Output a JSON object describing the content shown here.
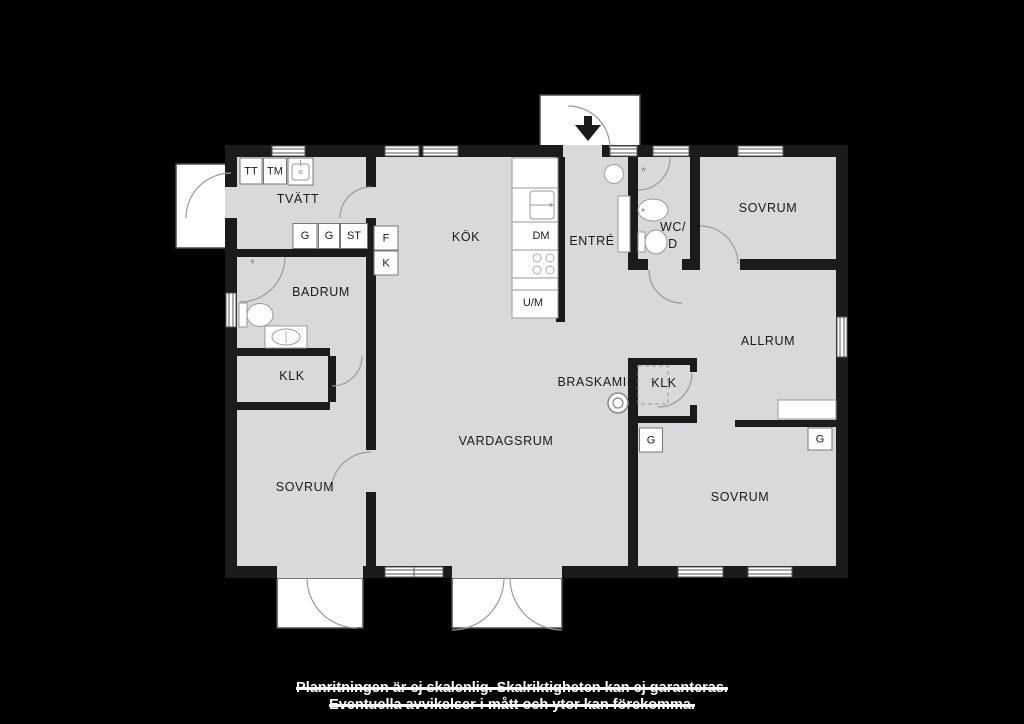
{
  "plan": {
    "colors": {
      "background": "#000000",
      "floor": "#d8d9da",
      "wall": "#1b1b1b",
      "porch": "#ffffff",
      "fixture_stroke": "#999999",
      "label_text": "#1a1a1a",
      "caption_text": "#ffffff"
    },
    "rooms": {
      "tvatt": "TVÄTT",
      "kok": "KÖK",
      "entre": "ENTRÉ",
      "wc_line1": "WC/",
      "wc_line2": "D",
      "sovrum_ne": "SOVRUM",
      "badrum": "BADRUM",
      "allrum": "ALLRUM",
      "klk_west": "KLK",
      "klk_east": "KLK",
      "braskamin": "BRASKAMIN",
      "vardagsrum": "VARDAGSRUM",
      "sovrum_sw": "SOVRUM",
      "sovrum_se": "SOVRUM"
    },
    "fixtures": {
      "tt": "TT",
      "tm": "TM",
      "g1": "G",
      "g2": "G",
      "st": "ST",
      "f": "F",
      "k": "K",
      "dm": "DM",
      "um": "U/M",
      "g3": "G",
      "g4": "G"
    },
    "caption": {
      "line1": "Planritningen är ej skalenlig. Skalriktigheten kan ej garanteras.",
      "line2": "Eventuella avvikelser i mått och ytor kan förekomma."
    }
  }
}
